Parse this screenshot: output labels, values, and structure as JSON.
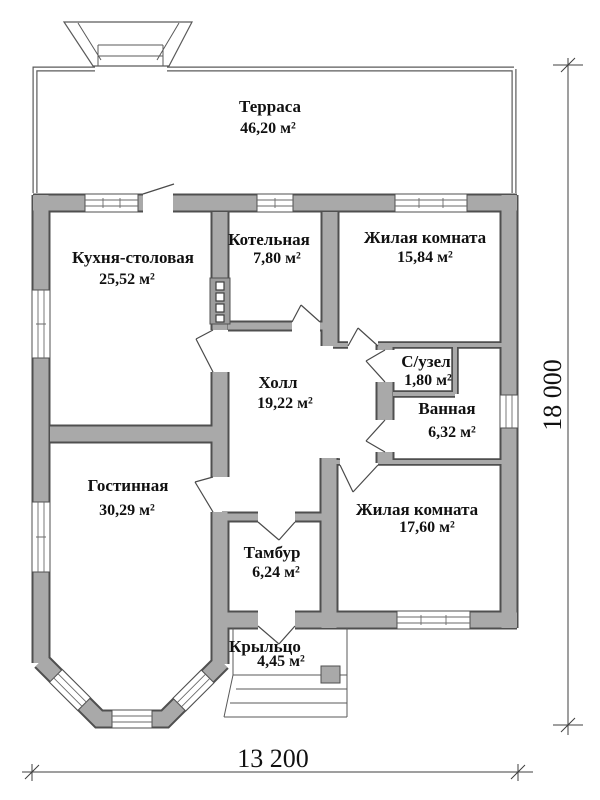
{
  "rooms": [
    {
      "name": "Терраса",
      "area": "46,20 м²"
    },
    {
      "name": "Кухня-столовая",
      "area": "25,52 м²"
    },
    {
      "name": "Котельная",
      "area": "7,80 м²"
    },
    {
      "name": "Жилая комната",
      "area": "15,84 м²"
    },
    {
      "name": "Холл",
      "area": "19,22 м²"
    },
    {
      "name": "С/узел",
      "area": "1,80 м²"
    },
    {
      "name": "Ванная",
      "area": "6,32 м²"
    },
    {
      "name": "Гостинная",
      "area": "30,29 м²"
    },
    {
      "name": "Жилая комната",
      "area": "17,60 м²"
    },
    {
      "name": "Тамбур",
      "area": "6,24 м²"
    },
    {
      "name": "Крыльцо",
      "area": "4,45 м²"
    }
  ],
  "dimensions": {
    "width": "13 200",
    "height": "18 000"
  },
  "colors": {
    "wall_fill": "#a9a9a9",
    "wall_outline": "#4f4f4f",
    "background": "#ffffff"
  }
}
